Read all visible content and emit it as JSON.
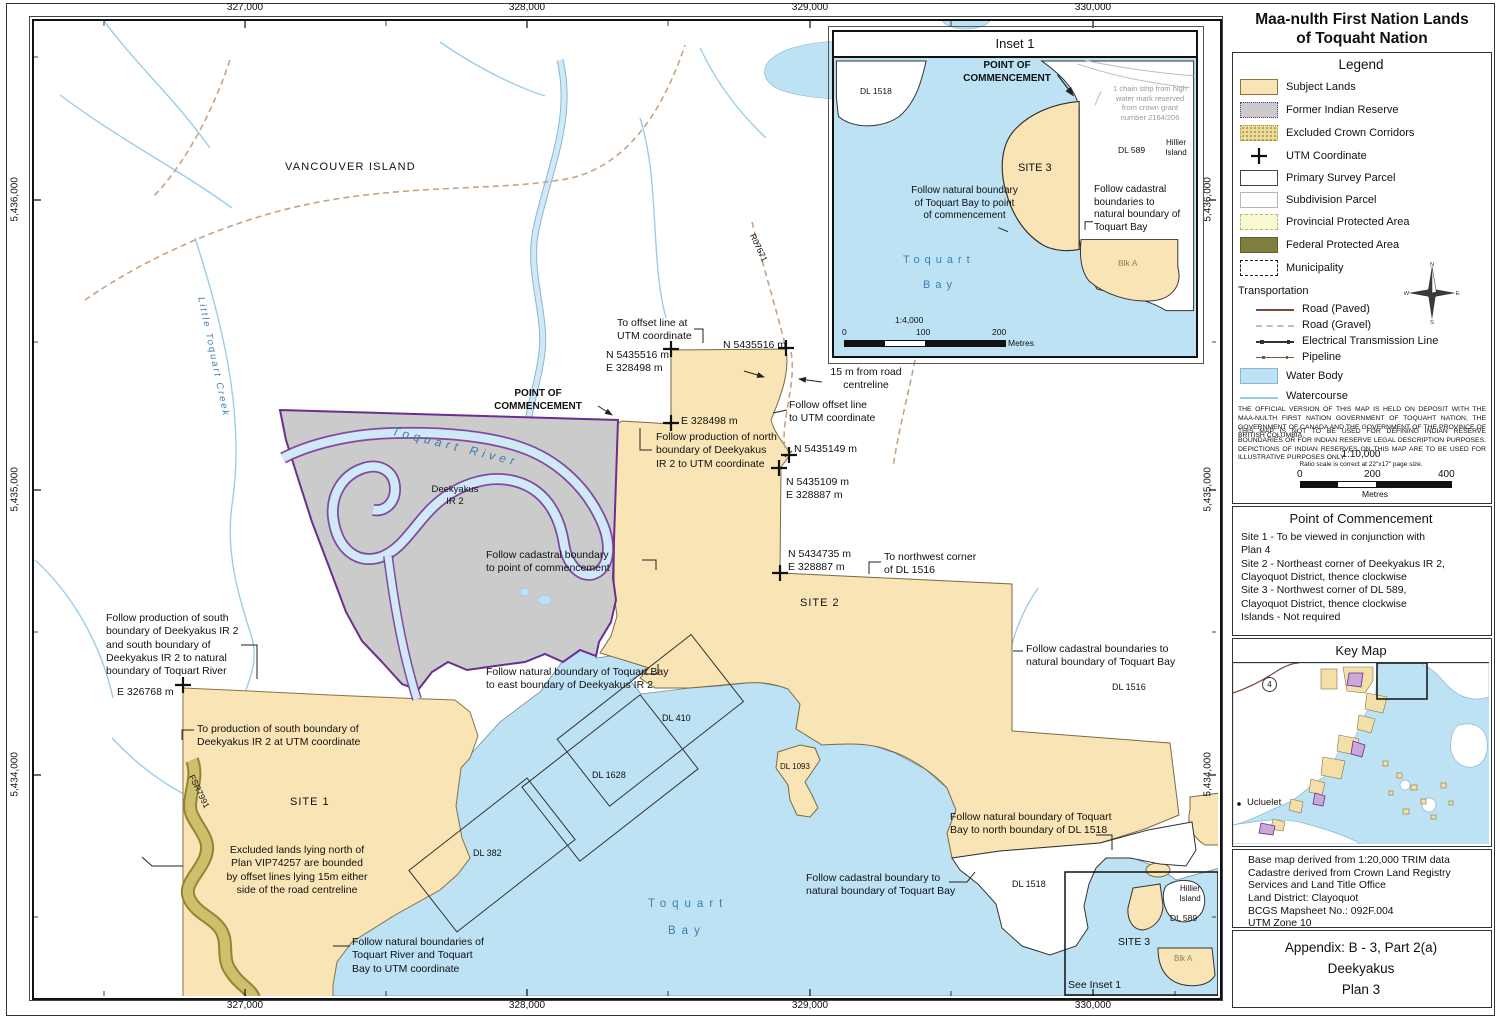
{
  "title": {
    "text": "Maa-nulth First Nation Lands\nof Toquaht Nation"
  },
  "grid": {
    "top": [
      "327,000",
      "328,000",
      "329,000",
      "330,000"
    ],
    "bottom": [
      "327,000",
      "328,000",
      "329,000",
      "330,000"
    ],
    "left": [
      "5,436,000",
      "5,435,000",
      "5,434,000"
    ],
    "right": [
      "5,436,000",
      "5,435,000",
      "5,434,000"
    ]
  },
  "map": {
    "labels": {
      "vancouver_island": "VANCOUVER ISLAND",
      "little_toquart_creek": "Little Toquart Creek",
      "toquart_river": "Toquart River",
      "deekyakus_ir2": "Deekyakus\nIR 2",
      "point_of_commencement": "POINT OF\nCOMMENCEMENT",
      "follow_cadastral_poc": "Follow cadastral boundary\nto point of commencement",
      "follow_natural_east": "Follow natural boundary of Toquart Bay\nto east boundary of Deekyakus IR 2",
      "to_offset_line": "To offset line at\nUTM coordinate",
      "n5435516_w": "N 5435516 m\nE   328498 m",
      "n5435516_e": "N 5435516 m",
      "e328498": "E 328498 m",
      "road_15m": "15 m from road\ncentreline",
      "follow_offset_line": "Follow offset line\nto UTM coordinate",
      "follow_prod_north": "Follow production of north\nboundary of Deekyakus\nIR 2 to UTM coordinate",
      "n5435149": "N 5435149 m",
      "n5435109": "N 5435109 m\nE   328887 m",
      "n5434735": "N 5434735 m\nE   328887 m",
      "to_nw_corner": "To northwest corner\nof DL 1516",
      "site2": "SITE 2",
      "follow_cad_1516": "Follow cadastral boundaries to\nnatural boundary of Toquart Bay",
      "dl1516": "DL 1516",
      "follow_prod_south": "Follow production of south\nboundary of Deekyakus IR 2\nand south boundary of\nDeekyakus IR 2 to natural\nboundary of Toquart River",
      "e326768": "E 326768 m",
      "to_prod_south": "To production of south boundary of\nDeekyakus IR 2 at UTM coordinate",
      "site1": "SITE 1",
      "fsr7991": "FSR7991",
      "excluded_lands": "Excluded lands lying north of\nPlan VIP74257 are bounded\nby offset lines lying 15m either\nside of the road centreline",
      "follow_natural_utm": "Follow natural boundaries of\nToquart River and Toquart\nBay to UTM coordinate",
      "dl382": "DL 382",
      "dl1628": "DL 1628",
      "dl410": "DL 410",
      "dl1093": "DL 1093",
      "toquart": "Toquart",
      "bay": "Bay",
      "follow_nat_1518": "Follow natural boundary of Toquart\nBay to north boundary of DL 1518",
      "follow_cad_nat": "Follow cadastral boundary to\nnatural boundary of Toquart Bay",
      "dl1518": "DL 1518",
      "hillier": "Hillier\nIsland",
      "dl589": "DL 589",
      "site3": "SITE 3",
      "blk_a": "Blk A",
      "see_inset": "See Inset 1",
      "r07671": "R07671"
    }
  },
  "inset": {
    "title": "Inset 1",
    "labels": {
      "point_of_commencement": "POINT OF\nCOMMENCEMENT",
      "dl1518": "DL 1518",
      "chain_strip": "1 chain strip from high\nwater mark reserved\nfrom crown grant\nnumber 2164/206",
      "dl589": "DL 589",
      "hillier": "Hillier\nIsland",
      "site3": "SITE 3",
      "follow_natural": "Follow natural boundary\nof Toquart Bay to point\nof commencement",
      "follow_cadastral": "Follow cadastral\nboundaries to\nnatural boundary of\nToquart Bay",
      "toquart": "Toquart",
      "bay": "Bay",
      "blk_a": "Blk A"
    },
    "scale": {
      "ratio": "1:4,000",
      "t0": "0",
      "t1": "100",
      "t2": "200",
      "unit": "Metres"
    }
  },
  "legend": {
    "title": "Legend",
    "items": [
      "Subject Lands",
      "Former Indian Reserve",
      "Excluded Crown Corridors",
      "UTM Coordinate",
      "Primary Survey Parcel",
      "Subdivision Parcel",
      "Provincial Protected Area",
      "Federal Protected Area",
      "Municipality"
    ],
    "transportation": "Transportation",
    "transport": [
      "Road (Paved)",
      "Road (Gravel)",
      "Electrical Transmission Line",
      "Pipeline"
    ],
    "water_body": "Water Body",
    "watercourse": "Watercourse",
    "disclaimer1": "THE OFFICIAL VERSION OF THIS MAP IS HELD ON DEPOSIT WITH THE MAA-NULTH FIRST NATION GOVERNMENT OF TOQUAHT NATION, THE GOVERNMENT OF CANADA AND THE GOVERNMENT OF THE PROVINCE OF BRITISH COLUMBIA.",
    "disclaimer2": "THIS MAP IS NOT TO BE USED FOR DEFINING INDIAN RESERVE BOUNDARIES OR FOR INDIAN RESERVE LEGAL DESCRIPTION PURPOSES.  DEPICTIONS OF INDIAN RESERVES ON THIS MAP ARE TO BE USED FOR ILLUSTRATIVE PURPOSES ONLY.",
    "scale": {
      "ratio": "1:10,000",
      "note": "Ratio scale is correct at 22\"x17\" page size.",
      "t0": "0",
      "t1": "200",
      "t2": "400",
      "unit": "Metres"
    },
    "compass": {
      "n": "N",
      "e": "E",
      "s": "S",
      "w": "W"
    }
  },
  "poc": {
    "title": "Point of Commencement",
    "body": "Site 1 - To be viewed in conjunction with\n   Plan 4\nSite 2 - Northeast corner of Deekyakus IR 2,\n   Clayoquot District, thence clockwise\nSite 3 - Northwest corner of DL 589,\n   Clayoquot District, thence clockwise\nIslands - Not required"
  },
  "keymap": {
    "title": "Key Map",
    "ucluelet": "Ucluelet",
    "highway": "4"
  },
  "basemap": {
    "text": "Base map derived from 1:20,000 TRIM data\nCadastre derived from Crown Land Registry\n   Services and Land Title Office\nLand District: Clayoquot\nBCGS Mapsheet No.: 092F.004\nUTM Zone 10"
  },
  "appendix": {
    "text": "Appendix:  B - 3, Part 2(a)\nDeekyakus\nPlan 3"
  },
  "colors": {
    "water": "#BDE2F4",
    "subject_lands": "#F9E4B5",
    "reserve": "#CBCBCB",
    "reserve_border": "#6B2D91",
    "excluded_corridor": "#CDBF6B",
    "provincial": "#FAFAD2",
    "federal": "#7E7E3F"
  }
}
